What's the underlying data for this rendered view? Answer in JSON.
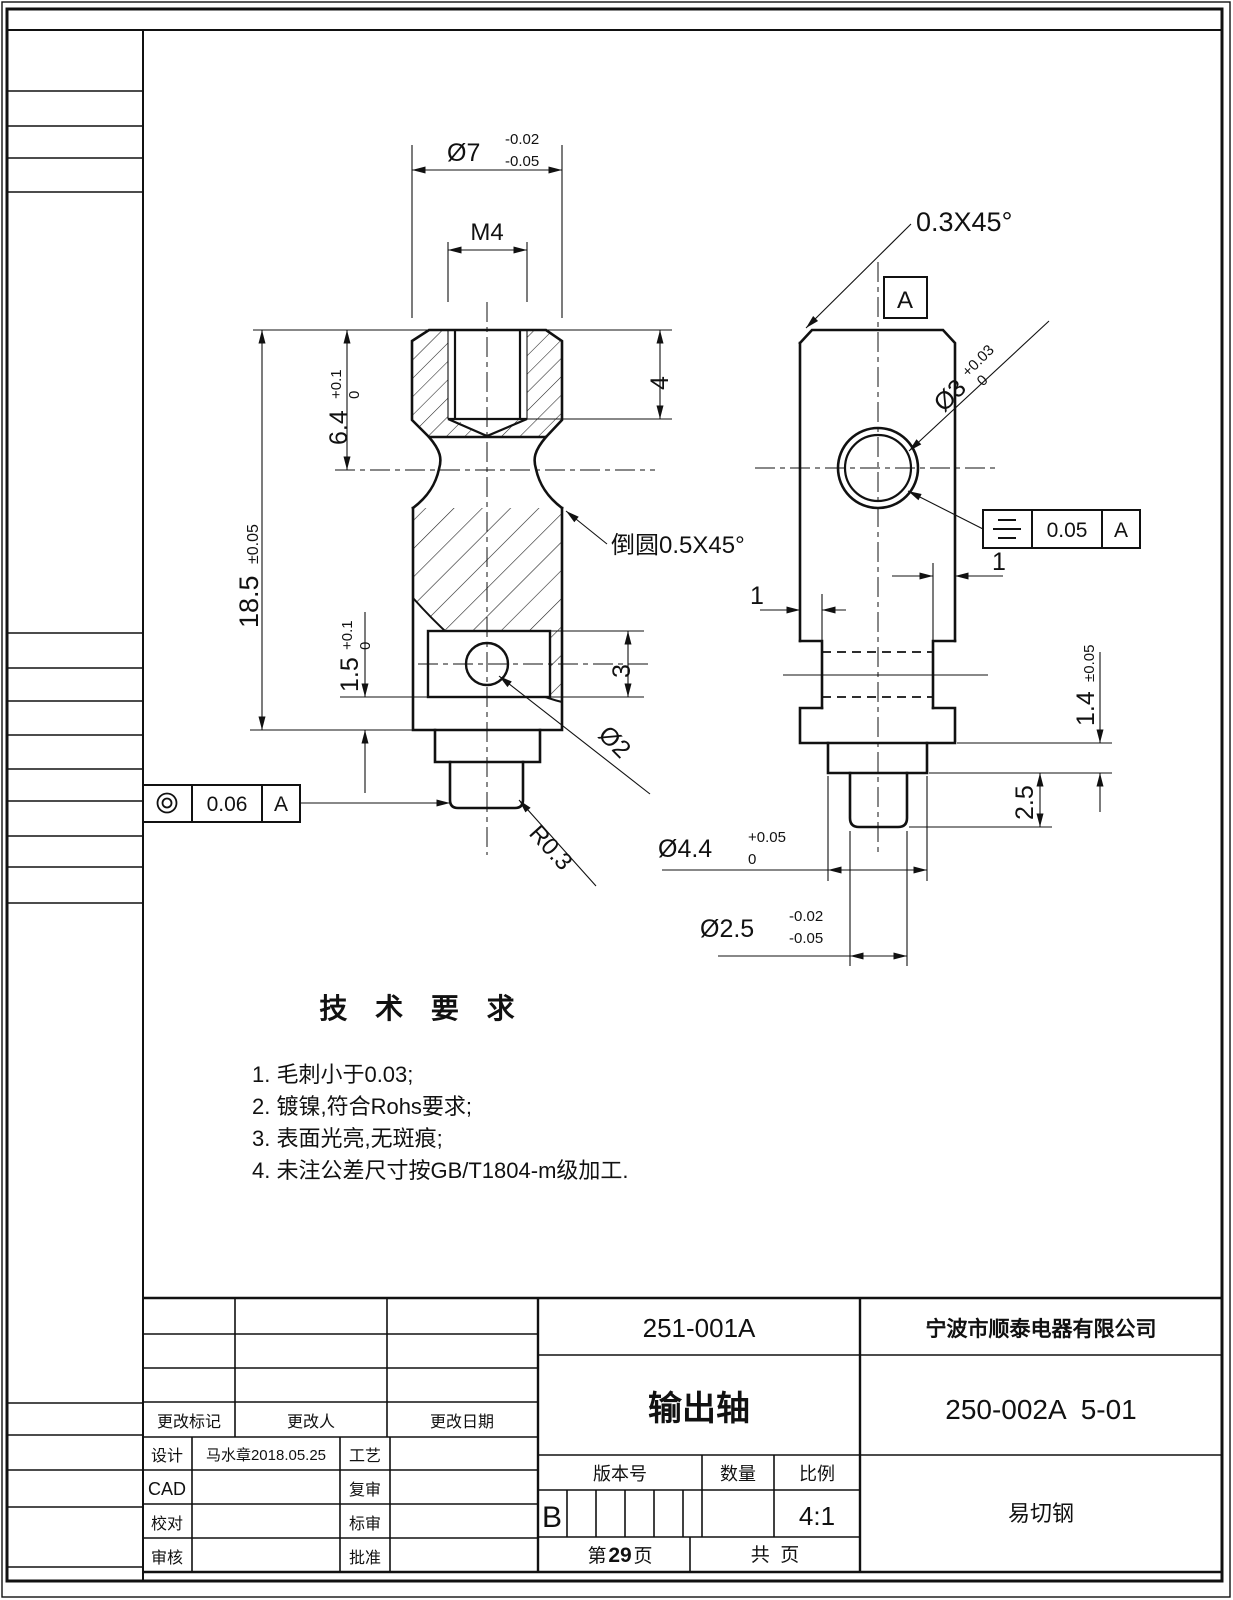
{
  "drawing": {
    "tech_requirements": {
      "title": "技 术 要 求",
      "items": [
        "1. 毛刺小于0.03;",
        "2. 镀镍,符合Rohs要求;",
        "3. 表面光亮,无斑痕;",
        "4. 未注公差尺寸按GB/T1804-m级加工."
      ]
    },
    "notes": {
      "fillet": "倒圆0.5X45°",
      "chamfer": "0.3X45°"
    },
    "datum_label": "A",
    "dims": {
      "dia7": {
        "v": "Ø7",
        "up": "-0.02",
        "low": "-0.05"
      },
      "m4": "M4",
      "thread_depth": "4",
      "upper_h": {
        "v": "6.4",
        "up": "+0.1",
        "low": "0"
      },
      "total_h": {
        "v": "18.5",
        "tol": "±0.05"
      },
      "slot_offset": {
        "v": "1.5",
        "up": "+0.1",
        "low": "0"
      },
      "slot_h": "3",
      "hole_d": "Ø2",
      "corner_r": "R0.3",
      "side_hole_d": {
        "v": "Ø3",
        "up": "+0.03",
        "low": "0"
      },
      "notch_left": "1",
      "notch_right": "1",
      "step_h": {
        "v": "1.4",
        "tol": "±0.05"
      },
      "tip_h": "2.5",
      "step_d": {
        "v": "Ø4.4",
        "up": "+0.05",
        "low": "0"
      },
      "tip_d": {
        "v": "Ø2.5",
        "up": "-0.02",
        "low": "-0.05"
      }
    },
    "gdt": {
      "concentricity": {
        "value": "0.06",
        "datum": "A"
      },
      "symmetry": {
        "value": "0.05",
        "datum": "A"
      }
    }
  },
  "title_block": {
    "doc_no": "251-001A",
    "company": "宁波市顺泰电器有限公司",
    "part_name": "输出轴",
    "part_no": "250-002A  5-01",
    "material": "易切钢",
    "version_label": "版本号",
    "qty_label": "数量",
    "scale_label": "比例",
    "version": "B",
    "scale": "4:1",
    "page_prefix": "第",
    "page_num": "29",
    "page_suffix": "页",
    "total_pages": "共  页",
    "change_mark": "更改标记",
    "change_by": "更改人",
    "change_date": "更改日期",
    "design": "设计",
    "design_val": "马水章2018.05.25",
    "process": "工艺",
    "cad": "CAD",
    "recheck": "复审",
    "check": "校对",
    "std": "标审",
    "audit": "审核",
    "approve": "批准"
  }
}
